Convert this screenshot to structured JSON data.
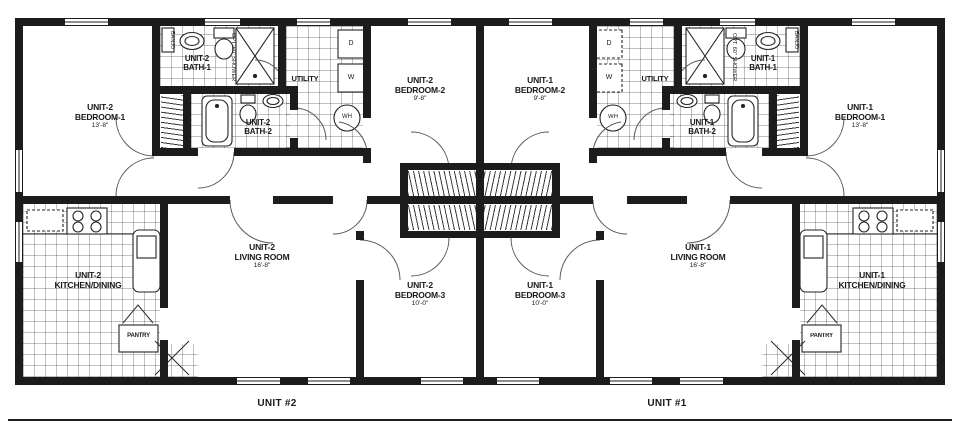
{
  "footer": {
    "unit2_label": "UNIT #2",
    "unit1_label": "UNIT #1"
  },
  "units": [
    {
      "bedroom1": {
        "unit": "UNIT-2",
        "name": "BEDROOM-1",
        "dim": "13'-8\""
      },
      "bedroom2": {
        "unit": "UNIT-2",
        "name": "BEDROOM-2",
        "dim": "9'-8\""
      },
      "bedroom3": {
        "unit": "UNIT-2",
        "name": "BEDROOM-3",
        "dim": "10'-0\""
      },
      "living": {
        "unit": "UNIT-2",
        "name": "LIVING ROOM",
        "dim": "16'-8\""
      },
      "kitchen": {
        "unit": "UNIT-2",
        "name": "KITCHEN/DINING"
      },
      "bath1": {
        "unit": "UNIT-2",
        "name": "BATH-1"
      },
      "bath2": {
        "unit": "UNIT-2",
        "name": "BATH-2"
      },
      "utility": "UTILITY",
      "pantry": "PANTRY",
      "banjo": "BANJO",
      "opt_shower": "OPT. 60\" SHOWER",
      "dryer": "D",
      "washer": "W",
      "water_heater": "WH"
    },
    {
      "bedroom1": {
        "unit": "UNIT-1",
        "name": "BEDROOM-1",
        "dim": "13'-8\""
      },
      "bedroom2": {
        "unit": "UNIT-1",
        "name": "BEDROOM-2",
        "dim": "9'-8\""
      },
      "bedroom3": {
        "unit": "UNIT-1",
        "name": "BEDROOM-3",
        "dim": "10'-0\""
      },
      "living": {
        "unit": "UNIT-1",
        "name": "LIVING ROOM",
        "dim": "16'-8\""
      },
      "kitchen": {
        "unit": "UNIT-1",
        "name": "KITCHEN/DINING"
      },
      "bath1": {
        "unit": "UNIT-1",
        "name": "BATH-1"
      },
      "bath2": {
        "unit": "UNIT-1",
        "name": "BATH-2"
      },
      "utility": "UTILITY",
      "pantry": "PANTRY",
      "banjo": "BANJO",
      "opt_shower": "OPT. 60\" SHOWER",
      "dryer": "D",
      "washer": "W",
      "water_heater": "WH"
    }
  ]
}
